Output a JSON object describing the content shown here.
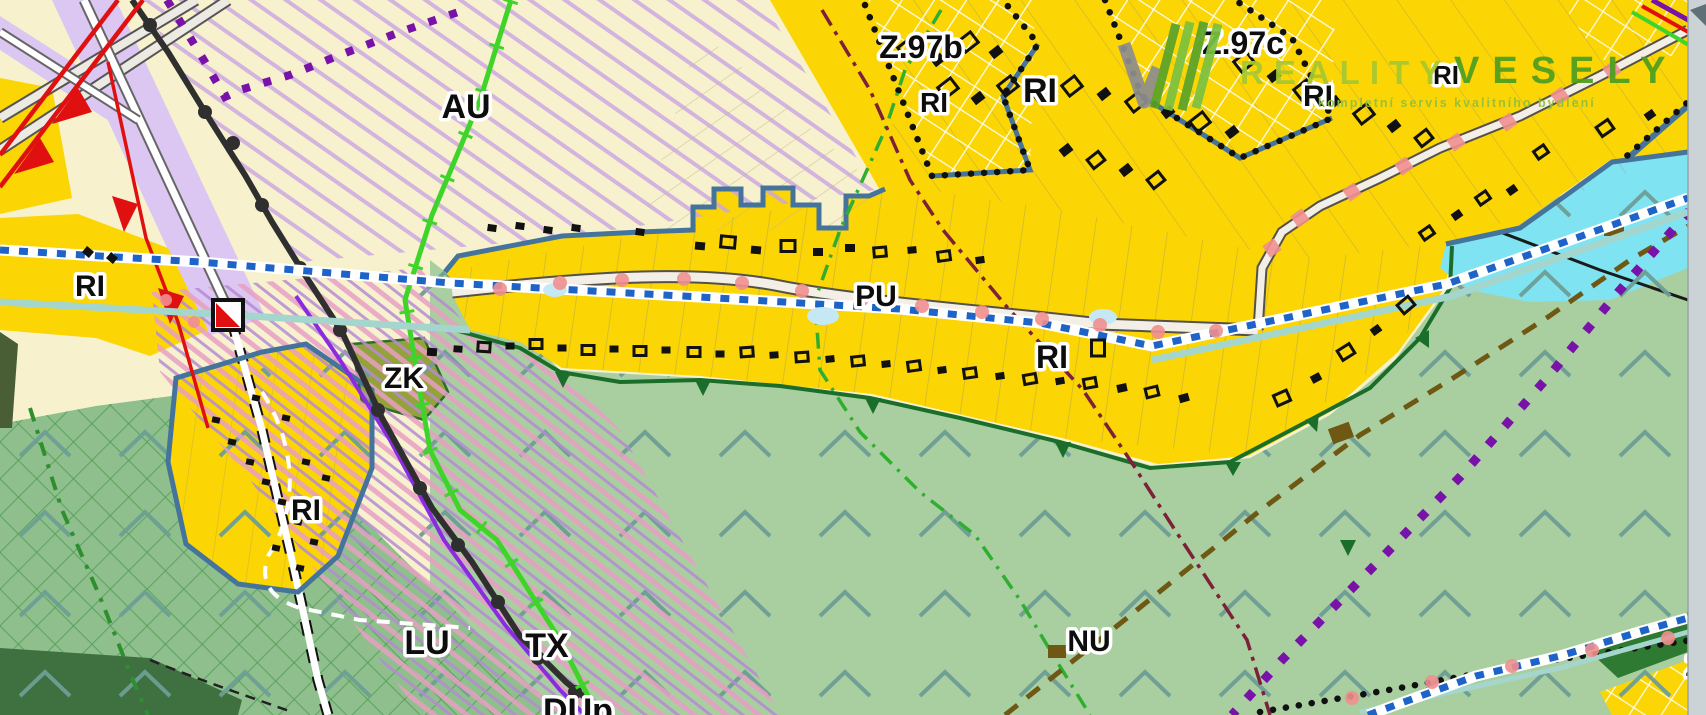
{
  "map": {
    "type": "zoning-plan-map",
    "logo": {
      "brand1": "REALITY",
      "brand2": "VESELY",
      "tagline": "kompletní servis kvalitního bydlení"
    },
    "labels": [
      {
        "t": "RI",
        "x": 90,
        "y": 296,
        "s": 30
      },
      {
        "t": "AU",
        "x": 466,
        "y": 118,
        "s": 34
      },
      {
        "t": "Z.97b",
        "x": 921,
        "y": 58,
        "s": 32
      },
      {
        "t": "RI",
        "x": 934,
        "y": 112,
        "s": 28
      },
      {
        "t": "RI",
        "x": 1040,
        "y": 102,
        "s": 34
      },
      {
        "t": "Z.97c",
        "x": 1243,
        "y": 54,
        "s": 32
      },
      {
        "t": "RI",
        "x": 1318,
        "y": 106,
        "s": 30
      },
      {
        "t": "RI",
        "x": 1446,
        "y": 84,
        "s": 26
      },
      {
        "t": "PU",
        "x": 876,
        "y": 306,
        "s": 30
      },
      {
        "t": "RI",
        "x": 1052,
        "y": 368,
        "s": 32
      },
      {
        "t": "ZK",
        "x": 404,
        "y": 388,
        "s": 30
      },
      {
        "t": "RI",
        "x": 306,
        "y": 520,
        "s": 30
      },
      {
        "t": "LU",
        "x": 427,
        "y": 654,
        "s": 34
      },
      {
        "t": "TX",
        "x": 547,
        "y": 657,
        "s": 34
      },
      {
        "t": "DUp",
        "x": 578,
        "y": 722,
        "s": 34
      },
      {
        "t": "NU",
        "x": 1089,
        "y": 651,
        "s": 30
      },
      {
        "t": "Z",
        "x": 1694,
        "y": 676,
        "s": 28
      }
    ],
    "buildings": [
      [
        492,
        228,
        9,
        7,
        8,
        0
      ],
      [
        520,
        226,
        9,
        7,
        8,
        0
      ],
      [
        548,
        230,
        9,
        7,
        8,
        0
      ],
      [
        576,
        228,
        9,
        7,
        8,
        0
      ],
      [
        640,
        232,
        9,
        7,
        8,
        0
      ],
      [
        700,
        246,
        10,
        8,
        5,
        0
      ],
      [
        728,
        242,
        14,
        11,
        5,
        1
      ],
      [
        756,
        250,
        10,
        8,
        5,
        0
      ],
      [
        788,
        246,
        14,
        11,
        0,
        1
      ],
      [
        818,
        252,
        10,
        8,
        0,
        0
      ],
      [
        850,
        248,
        10,
        8,
        0,
        0
      ],
      [
        880,
        252,
        12,
        9,
        -5,
        1
      ],
      [
        912,
        250,
        9,
        7,
        -5,
        0
      ],
      [
        944,
        256,
        12,
        9,
        -8,
        1
      ],
      [
        980,
        260,
        9,
        7,
        -8,
        0
      ],
      [
        432,
        352,
        10,
        8,
        4,
        0
      ],
      [
        458,
        349,
        9,
        7,
        4,
        0
      ],
      [
        484,
        347,
        12,
        9,
        4,
        1
      ],
      [
        510,
        346,
        9,
        7,
        0,
        0
      ],
      [
        536,
        344,
        12,
        9,
        0,
        1
      ],
      [
        562,
        348,
        9,
        7,
        0,
        0
      ],
      [
        588,
        350,
        12,
        9,
        0,
        1
      ],
      [
        614,
        349,
        9,
        7,
        0,
        0
      ],
      [
        640,
        351,
        12,
        9,
        0,
        1
      ],
      [
        666,
        350,
        9,
        7,
        0,
        0
      ],
      [
        694,
        352,
        12,
        9,
        0,
        1
      ],
      [
        720,
        354,
        9,
        7,
        0,
        0
      ],
      [
        747,
        352,
        12,
        9,
        -4,
        1
      ],
      [
        774,
        355,
        9,
        7,
        -4,
        0
      ],
      [
        802,
        357,
        12,
        9,
        -4,
        1
      ],
      [
        830,
        359,
        9,
        7,
        -6,
        0
      ],
      [
        858,
        361,
        12,
        9,
        -6,
        1
      ],
      [
        886,
        364,
        9,
        7,
        -6,
        0
      ],
      [
        914,
        366,
        12,
        9,
        -8,
        1
      ],
      [
        942,
        370,
        9,
        7,
        -8,
        0
      ],
      [
        970,
        373,
        12,
        9,
        -8,
        1
      ],
      [
        1000,
        376,
        9,
        7,
        -8,
        0
      ],
      [
        1030,
        379,
        12,
        9,
        -10,
        1
      ],
      [
        1060,
        381,
        9,
        7,
        -10,
        0
      ],
      [
        1090,
        383,
        12,
        9,
        -10,
        1
      ],
      [
        1122,
        388,
        10,
        8,
        -12,
        0
      ],
      [
        1152,
        392,
        12,
        9,
        -14,
        1
      ],
      [
        1184,
        398,
        10,
        8,
        -16,
        0
      ],
      [
        1282,
        398,
        14,
        11,
        -24,
        1
      ],
      [
        1316,
        378,
        10,
        8,
        -28,
        0
      ],
      [
        1346,
        352,
        14,
        11,
        -32,
        1
      ],
      [
        1376,
        330,
        10,
        8,
        -36,
        0
      ],
      [
        1406,
        305,
        14,
        11,
        -40,
        1
      ],
      [
        908,
        48,
        16,
        13,
        -38,
        1
      ],
      [
        938,
        60,
        12,
        9,
        -38,
        0
      ],
      [
        968,
        42,
        16,
        13,
        -38,
        1
      ],
      [
        996,
        52,
        12,
        9,
        -38,
        0
      ],
      [
        948,
        88,
        16,
        13,
        -38,
        1
      ],
      [
        978,
        98,
        12,
        9,
        -38,
        0
      ],
      [
        1008,
        86,
        16,
        13,
        -38,
        1
      ],
      [
        1040,
        96,
        12,
        9,
        -38,
        0
      ],
      [
        1072,
        86,
        16,
        13,
        -38,
        1
      ],
      [
        1104,
        94,
        12,
        9,
        -38,
        0
      ],
      [
        1136,
        102,
        16,
        13,
        -38,
        1
      ],
      [
        1168,
        112,
        12,
        9,
        -38,
        0
      ],
      [
        1200,
        122,
        16,
        13,
        -38,
        1
      ],
      [
        1232,
        132,
        12,
        9,
        -38,
        0
      ],
      [
        1244,
        62,
        16,
        13,
        -38,
        1
      ],
      [
        1274,
        76,
        12,
        9,
        -38,
        0
      ],
      [
        1304,
        90,
        16,
        13,
        -38,
        1
      ],
      [
        1334,
        102,
        12,
        9,
        -38,
        0
      ],
      [
        1364,
        114,
        16,
        13,
        -38,
        1
      ],
      [
        1394,
        126,
        12,
        9,
        -38,
        0
      ],
      [
        1424,
        138,
        14,
        11,
        -38,
        1
      ],
      [
        1066,
        150,
        12,
        9,
        -38,
        0
      ],
      [
        1096,
        160,
        14,
        11,
        -38,
        1
      ],
      [
        1126,
        170,
        12,
        9,
        -38,
        0
      ],
      [
        1156,
        180,
        14,
        11,
        -38,
        1
      ],
      [
        1427,
        233,
        12,
        9,
        -35,
        1
      ],
      [
        1457,
        215,
        10,
        8,
        -35,
        0
      ],
      [
        1483,
        198,
        12,
        9,
        -35,
        1
      ],
      [
        1512,
        190,
        10,
        8,
        -35,
        0
      ],
      [
        1541,
        152,
        12,
        9,
        -35,
        1
      ],
      [
        1605,
        128,
        14,
        11,
        -35,
        1
      ],
      [
        1650,
        115,
        10,
        8,
        -35,
        0
      ],
      [
        216,
        420,
        8,
        6,
        12,
        0
      ],
      [
        232,
        442,
        8,
        6,
        12,
        0
      ],
      [
        250,
        462,
        8,
        6,
        12,
        0
      ],
      [
        266,
        482,
        8,
        6,
        12,
        0
      ],
      [
        282,
        502,
        8,
        6,
        12,
        0
      ],
      [
        298,
        522,
        8,
        6,
        12,
        0
      ],
      [
        314,
        542,
        8,
        6,
        12,
        0
      ],
      [
        256,
        398,
        8,
        6,
        12,
        0
      ],
      [
        286,
        418,
        8,
        6,
        12,
        0
      ],
      [
        306,
        462,
        8,
        6,
        12,
        0
      ],
      [
        326,
        478,
        8,
        6,
        12,
        0
      ],
      [
        276,
        548,
        8,
        6,
        12,
        0
      ],
      [
        300,
        568,
        8,
        6,
        12,
        0
      ],
      [
        88,
        252,
        9,
        8,
        40,
        0
      ],
      [
        112,
        258,
        9,
        8,
        40,
        0
      ],
      [
        1098,
        348,
        13,
        16,
        0,
        1
      ]
    ],
    "road_dots": [
      [
        500,
        289,
        7,
        0
      ],
      [
        560,
        283,
        7,
        0
      ],
      [
        622,
        280,
        7,
        0
      ],
      [
        684,
        279,
        7,
        0
      ],
      [
        742,
        283,
        7,
        0
      ],
      [
        802,
        291,
        7,
        0
      ],
      [
        862,
        299,
        7,
        0
      ],
      [
        922,
        306,
        7,
        0
      ],
      [
        982,
        312,
        7,
        0
      ],
      [
        1042,
        319,
        7,
        0
      ],
      [
        1100,
        325,
        7,
        0
      ],
      [
        1158,
        332,
        7,
        0
      ],
      [
        1216,
        331,
        7,
        0
      ],
      [
        1612,
        70,
        7,
        1
      ],
      [
        1560,
        96,
        7,
        1
      ],
      [
        1508,
        122,
        7,
        1
      ],
      [
        1456,
        142,
        7,
        1
      ],
      [
        1404,
        166,
        7,
        1
      ],
      [
        1352,
        192,
        7,
        1
      ],
      [
        1300,
        218,
        7,
        1
      ],
      [
        1272,
        248,
        7,
        1
      ],
      [
        1352,
        698,
        7,
        0
      ],
      [
        1432,
        682,
        7,
        0
      ],
      [
        1512,
        666,
        7,
        0
      ],
      [
        1592,
        650,
        7,
        0
      ],
      [
        1668,
        638,
        7,
        0
      ],
      [
        194,
        322,
        6,
        0
      ],
      [
        166,
        300,
        6,
        0
      ]
    ],
    "symbol": {
      "name": "red-white-control-flag",
      "x": 213,
      "y": 300,
      "size": 30
    }
  },
  "colors": {
    "cream": "#f7f2cd",
    "yellow": "#fbd504",
    "greenLight": "#a9cfa0",
    "greenMid": "#8fbf8c",
    "greenDark": "#2e7d32",
    "olive": "#95a23b",
    "water": "#7fe3f2",
    "lilac": "#dcc7f2",
    "steel": "#44749c",
    "routeBlue": "#1e63c8",
    "rail": "#2f2f2f",
    "red": "#e01010",
    "brightGreen": "#3fd42a",
    "purple": "#7812a8",
    "maroon": "#7c2138",
    "brown": "#6e5813",
    "roadFill": "#f4efe6",
    "grayStrip": "#ccd3d6",
    "chevron": "#6d9e94",
    "pinkDot": "#ef8f8f",
    "logoGreenLight": "#a6c832",
    "logoGreenDark": "#4e9e1f"
  }
}
